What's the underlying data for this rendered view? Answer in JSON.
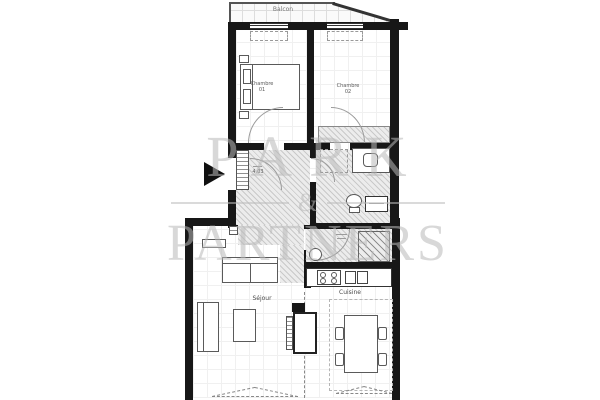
{
  "watermark": {
    "line1": "PARK",
    "ampersand": "&",
    "line2": "PARTNERS",
    "color": "#b9b9b9"
  },
  "balcony": {
    "label": "Balcon"
  },
  "bedroom1": {
    "name": "Chambre",
    "number": "01"
  },
  "bedroom2": {
    "name": "Chambre",
    "number": "02"
  },
  "living_room": {
    "label": "Séjour"
  },
  "kitchen": {
    "label": "Cuisine"
  },
  "entry": {
    "door_label": "4.03"
  },
  "colors": {
    "wall": "#171717",
    "hatch_bg": "#ececec",
    "hatch_line": "#c9c9c9",
    "watermark": "#b9b9b9",
    "label_text": "#4a4a4a"
  }
}
